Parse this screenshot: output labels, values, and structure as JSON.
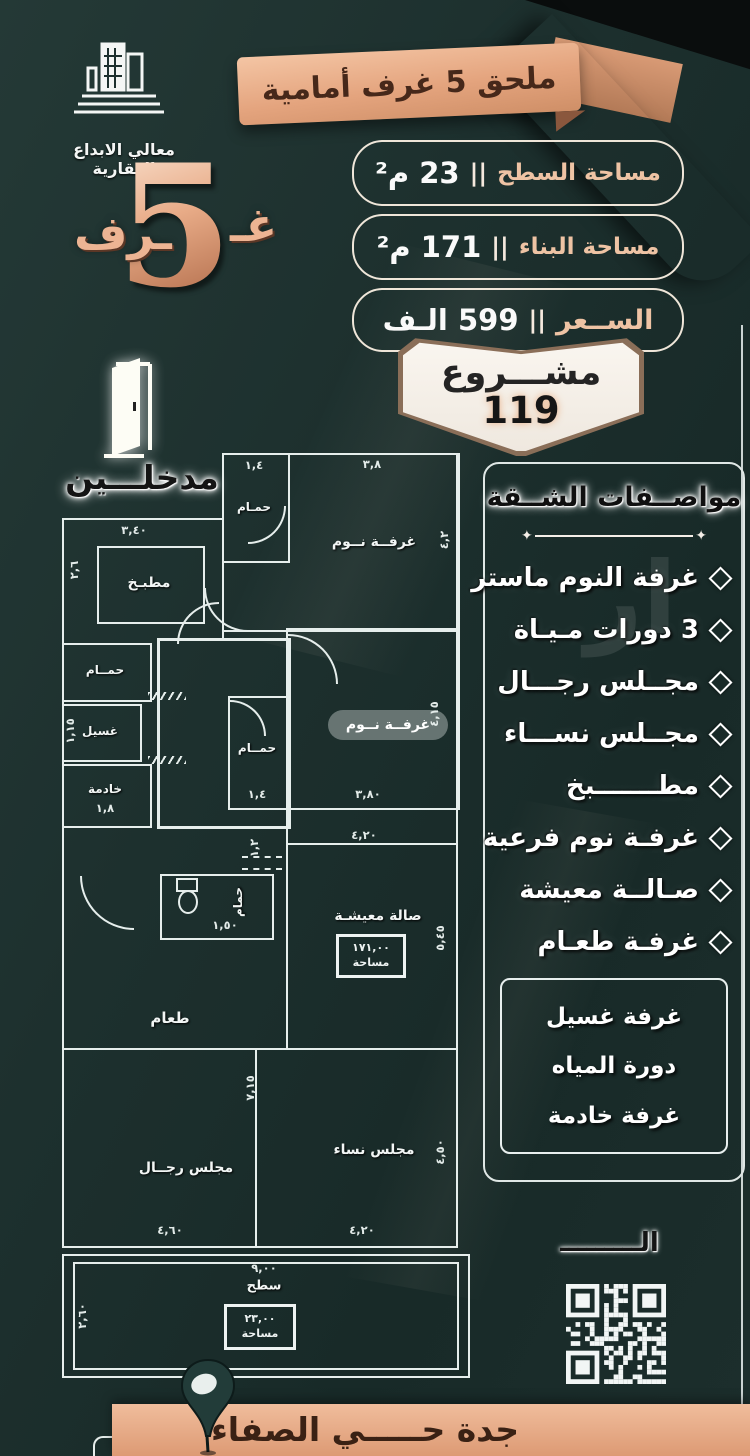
{
  "brand": {
    "name": "معالي الابداع العقارية"
  },
  "top_banner": {
    "text": "ملحق 5 غرف أمامية"
  },
  "rooms_count": {
    "suffix_right": "غـ",
    "number": "5",
    "suffix_left": "ـرف"
  },
  "entrances": {
    "label": "مدخلـــين"
  },
  "info_rows": [
    {
      "label": "مساحة السطح",
      "divider": "||",
      "value": "23 م²"
    },
    {
      "label": "مساحة البناء",
      "divider": "||",
      "value": "171 م²"
    },
    {
      "label": "الســعر",
      "divider": "||",
      "value": "599 الـف"
    }
  ],
  "project_badge": {
    "title": "مشـــروع",
    "number": "119"
  },
  "features": {
    "title": "مواصــفات الشــقة",
    "items": [
      {
        "text": "غرفة النوم ماستر"
      },
      {
        "text": "3 دورات مـيـاة"
      },
      {
        "text": "مجــلس رجـــال"
      },
      {
        "text": "مجــلس نســـاء"
      },
      {
        "text": "مطـــــــبخ"
      },
      {
        "text": "غرفـة نوم فرعية"
      },
      {
        "text": "صـالــة معيشة"
      },
      {
        "text": "غرفـة طعـام"
      }
    ],
    "extra_box": [
      {
        "text": "غرفة غسيل"
      },
      {
        "text": "دورة المياه"
      },
      {
        "text": "غرفة خادمة"
      }
    ]
  },
  "watermark": {
    "text": "ار"
  },
  "floorplan": {
    "labels": {
      "bath_top": "حمـام",
      "bedroom_top": "غرفــة نــوم",
      "kitchen": "مطبـخ",
      "bath_left": "حمــام",
      "laundry": "غسيل",
      "maid": "خادمة",
      "bath_mid": "حمــام",
      "bedroom_mid": "غرفــة نــوم",
      "wc": "حمام",
      "living": "صالة معيشـة",
      "living_area_value": "١٧١,٠٠",
      "living_area_label": "مساحة",
      "dining": "طعام",
      "majlis_men": "مجلس رجــال",
      "majlis_women": "مجلس نساء",
      "roof": "سطح",
      "roof_area_value": "٢٣,٠٠",
      "roof_area_label": "مساحة"
    },
    "dims": {
      "bath_top_w": "١,٤",
      "bedroom_top_w": "٣,٨",
      "bedroom_top_h": "٤,٢",
      "kitchen_w": "٣,٤٠",
      "kitchen_h": "٢,٦",
      "laundry_h": "١,١٥",
      "maid_w": "١,٨",
      "bath_mid_w": "١,٤",
      "bedroom_mid_h": "٤,١٥",
      "bedroom_mid_w": "٣,٨٠",
      "hall_w": "٤,٢٠",
      "hall_door": "١,٢",
      "wc_w": "١,٥٠",
      "living_h": "٥,٤٥",
      "men_h": "٧,١٥",
      "men_w": "٤,٦٠",
      "women_w": "٤,٢٠",
      "women_h": "٤,٥٠",
      "roof_w": "٩,٠٠",
      "roof_h": "٢,٦٠"
    }
  },
  "qr_section": {
    "caption": "الـــــــــ"
  },
  "location_bar": {
    "text": "جدة حـــــي الصفاء"
  },
  "colors": {
    "background": "#1d302e",
    "accent_peach": "#e9ad8c",
    "wall_white": "#e6eeec",
    "dark_text": "#3b2317"
  }
}
